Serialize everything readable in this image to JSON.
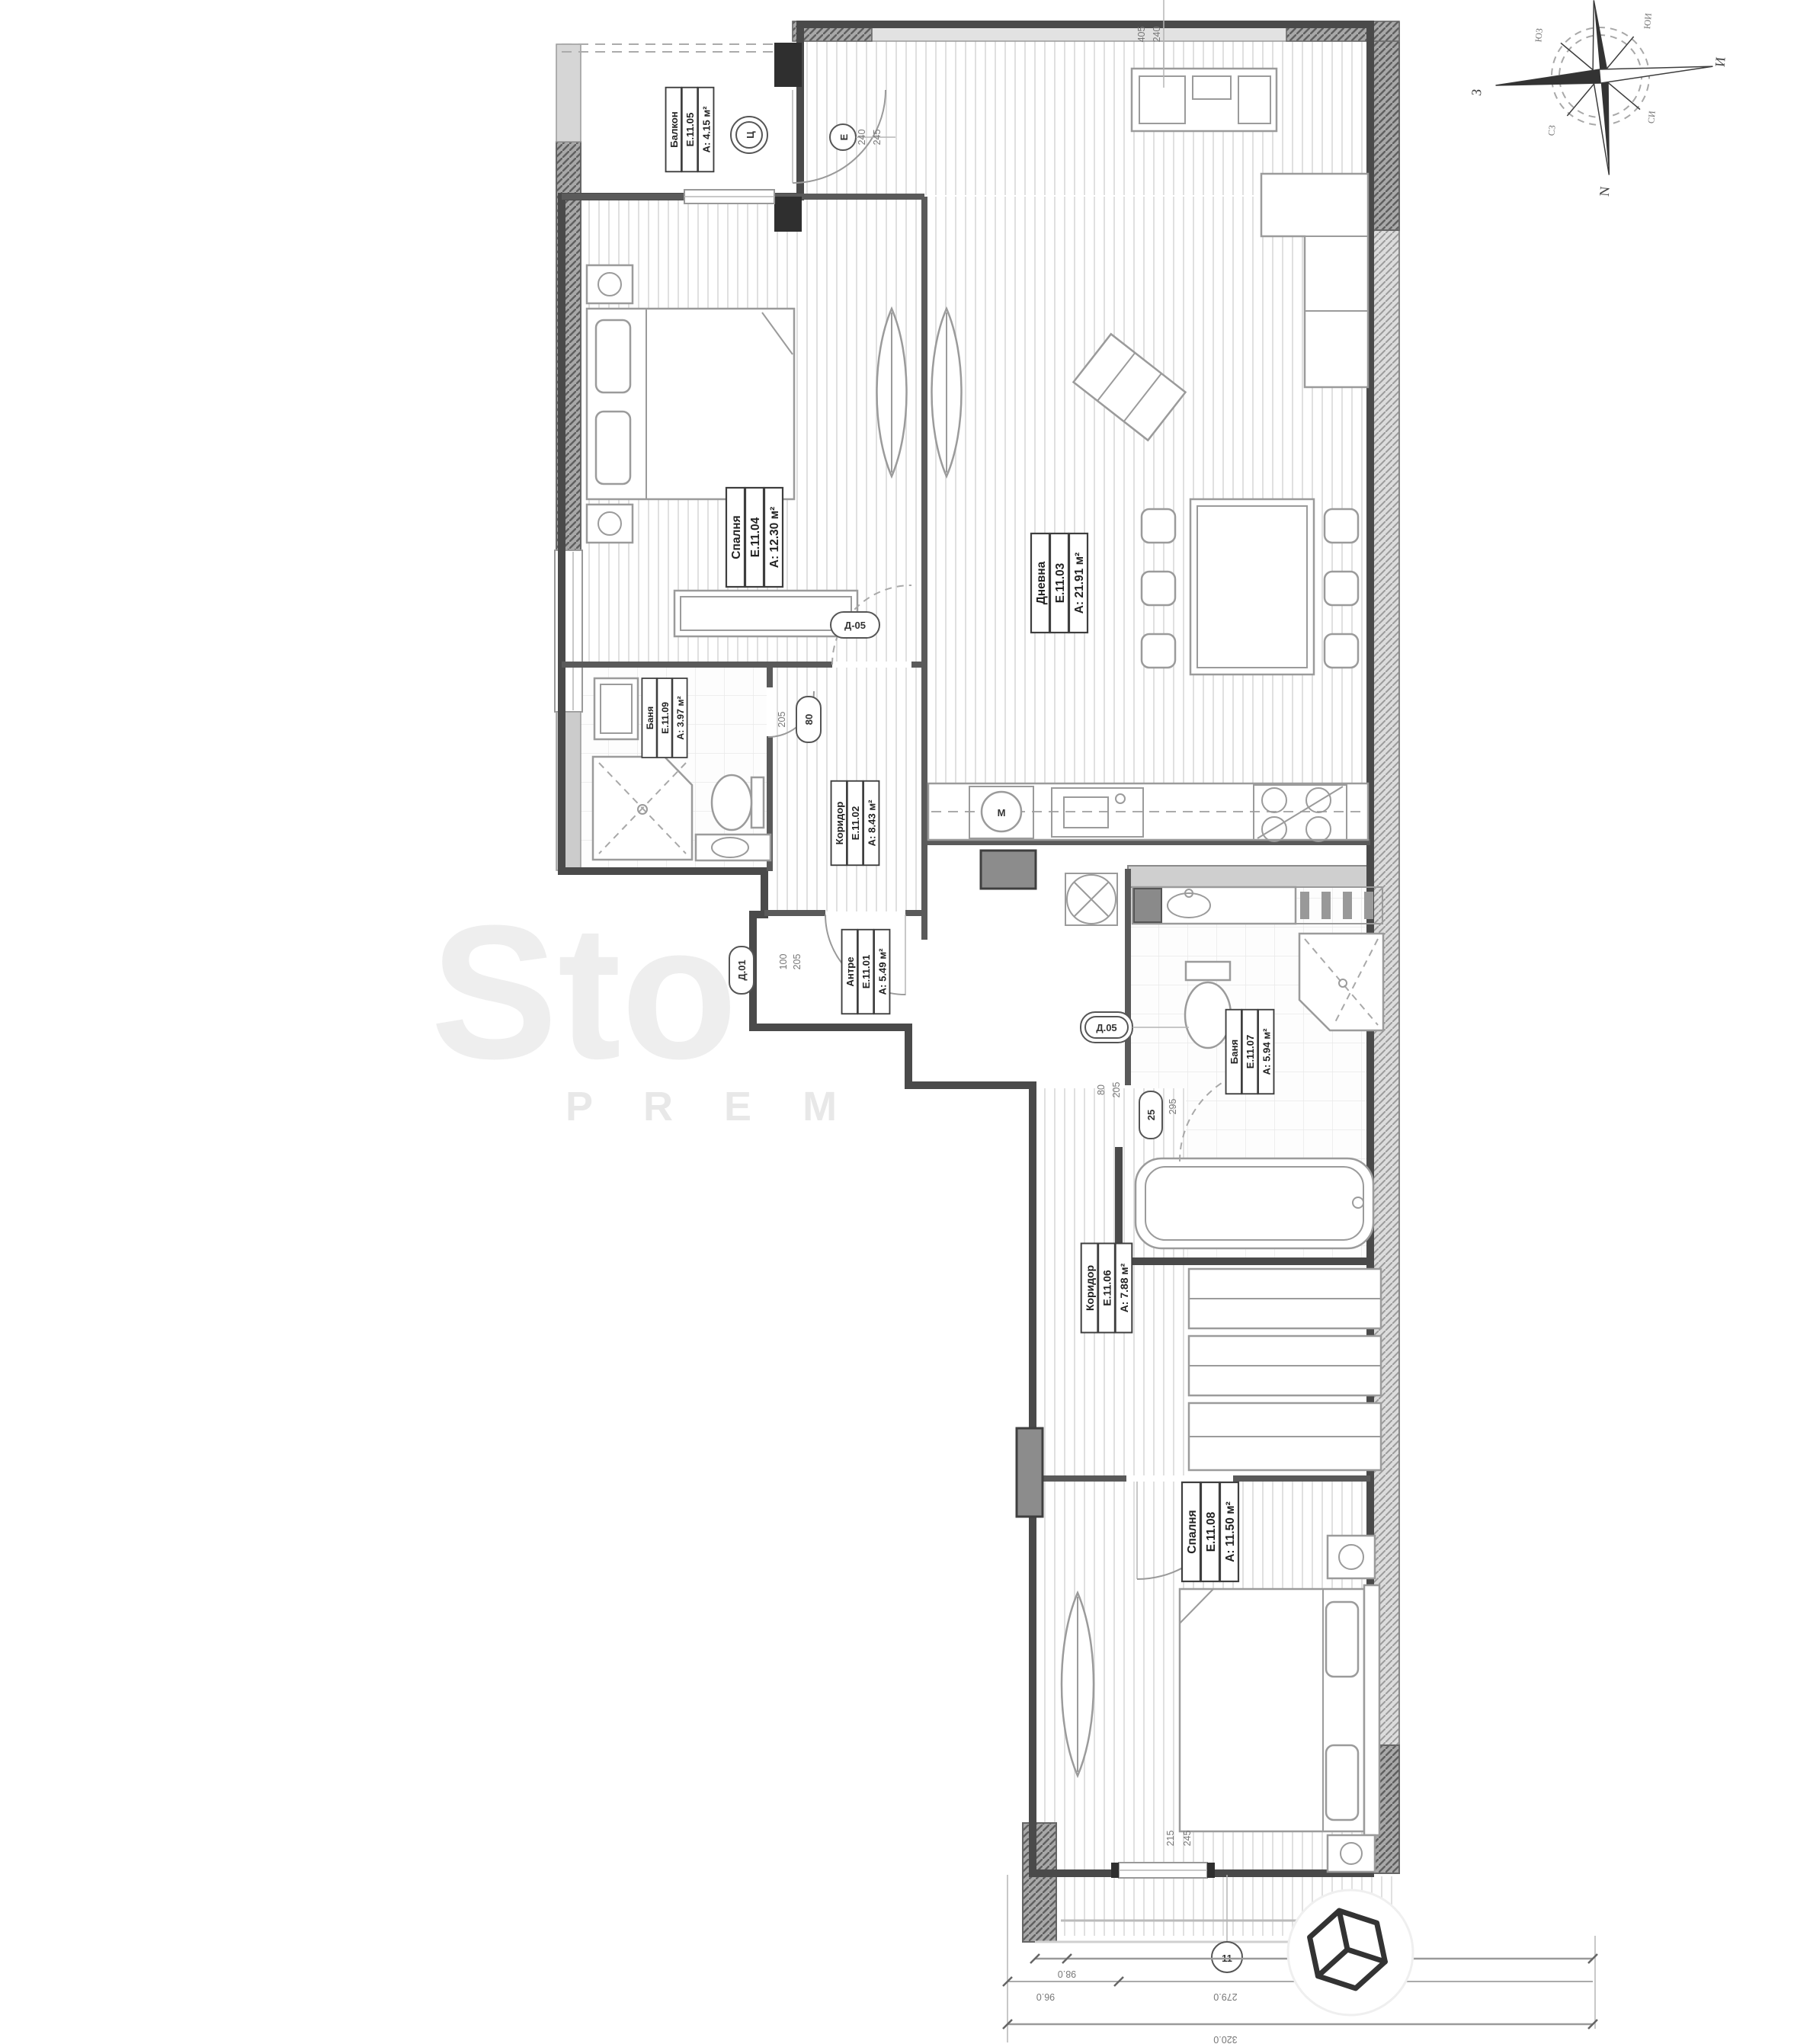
{
  "plan_title": "apartment-floor-plan",
  "rooms": [
    {
      "name": "Балкон",
      "code": "Е.11.05",
      "area": "А: 4.15 м²"
    },
    {
      "name": "Спалня",
      "code": "Е.11.04",
      "area": "А: 12.30 м²"
    },
    {
      "name": "Дневна",
      "code": "Е.11.03",
      "area": "А: 21.91 м²"
    },
    {
      "name": "Баня",
      "code": "Е.11.09",
      "area": "А: 3.97 м²"
    },
    {
      "name": "Коридор",
      "code": "Е.11.02",
      "area": "А: 8.43 м²"
    },
    {
      "name": "Антре",
      "code": "Е.11.01",
      "area": "А: 5.49 м²"
    },
    {
      "name": "Баня",
      "code": "Е.11.07",
      "area": "А: 5.94 м²"
    },
    {
      "name": "Коридор",
      "code": "Е.11.06",
      "area": "А: 7.88 м²"
    },
    {
      "name": "Спалня",
      "code": "Е.11.08",
      "area": "А: 11.50 м²"
    }
  ],
  "markers": {
    "circle1": "Ц",
    "circle2": "Е",
    "door_corridor": "Д-05",
    "door_bath1": "80",
    "door_bath1_out": "205",
    "door_entry": "Д.01",
    "door_hall2": "Д.05",
    "door_small2": "25",
    "axis_bubble": "11",
    "washer": "М"
  },
  "dims": {
    "balcony_a": "240",
    "balcony_b": "245",
    "top_a": "405",
    "top_b": "240",
    "entry_a": "100",
    "entry_b": "205",
    "bath2_a": "80",
    "bath2_b": "205",
    "bath2_c": "295",
    "bd2_a": "215",
    "bd2_b": "245",
    "bot_a": "98.0",
    "bot_b": "96.0",
    "bot_c": "279.0",
    "bot_d": "320.0"
  },
  "compass": {
    "north": "N",
    "west": "З",
    "east": "И",
    "nw": "СЗ",
    "ne": "СИ",
    "sw": "ЮЗ",
    "se": "ЮИ"
  },
  "watermark": {
    "big": "Sto",
    "small": "P R E M"
  },
  "colors": {
    "wall": "#4a4a4a",
    "shaft": "#8c8c8c",
    "floor_stripe": "#dedede"
  }
}
